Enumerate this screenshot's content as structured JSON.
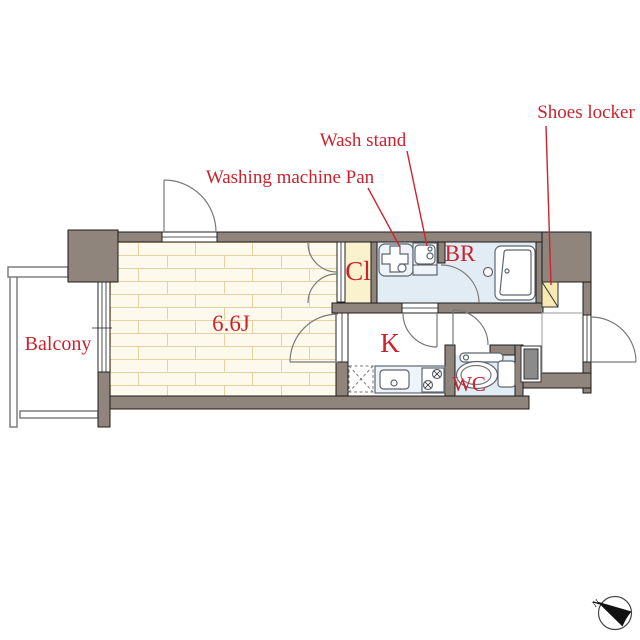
{
  "floorplan": {
    "rooms": {
      "balcony": "Balcony",
      "main_room_size": "6.6J",
      "closet": "Cl",
      "bathroom": "BR",
      "kitchen": "K",
      "toilet": "WC"
    },
    "annotations": {
      "washing_machine_pan": "Washing machine Pan",
      "wash_stand": "Wash stand",
      "shoes_locker": "Shoes locker"
    },
    "compass": {
      "north_label": "N"
    },
    "colors": {
      "wall": "#90857d",
      "label_red": "#c9242e",
      "main_room_floor": "#fdf9ec",
      "brick_line": "#e8d09e",
      "closet_floor": "#faf1cd",
      "sanitary_floor": "#e2ecf5",
      "shoes_locker_fill": "#f6eab2",
      "pipe_space_fill": "#8b8b8b"
    }
  }
}
